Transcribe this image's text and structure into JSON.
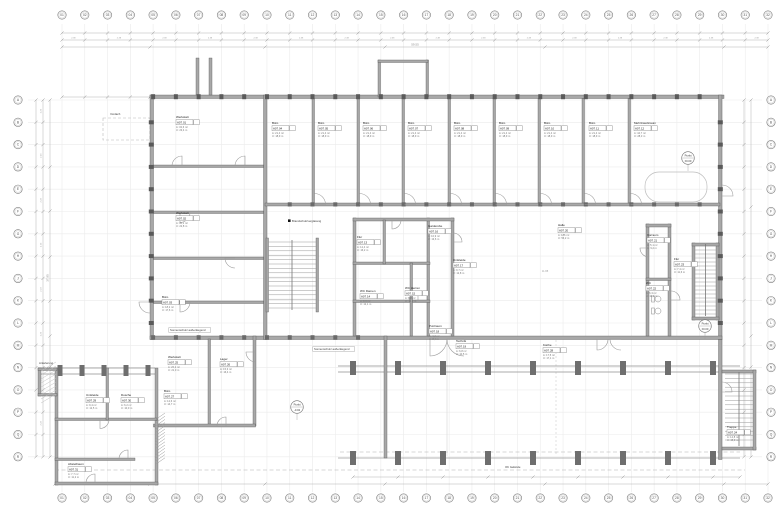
{
  "meta": {
    "drawing_type": "Grundriss / floor plan working drawing"
  },
  "colors": {
    "paper": "#ffffff",
    "wall_fill": "#a8a8a8",
    "wall_edge": "#4f4f4f",
    "pier": "#6e6e6e",
    "door": "#9b9b9b",
    "dim": "#b2b2b2",
    "grid": "#ebebeb",
    "stair": "#9a9a9a",
    "text": "#3c3c3c",
    "muted": "#8a8a8a"
  },
  "grid": {
    "top": [
      "01",
      "02",
      "03",
      "04",
      "05",
      "06",
      "07",
      "08",
      "09",
      "10",
      "11",
      "12",
      "13",
      "14",
      "15",
      "16",
      "17",
      "18",
      "19",
      "20",
      "21",
      "22",
      "23",
      "24",
      "25",
      "26",
      "27",
      "28",
      "29",
      "30",
      "31",
      "32"
    ],
    "bottom": [
      "01",
      "02",
      "03",
      "04",
      "05",
      "06",
      "07",
      "08",
      "09",
      "10",
      "11",
      "12",
      "13",
      "14",
      "15",
      "16",
      "17",
      "18",
      "19",
      "20",
      "21",
      "22",
      "23",
      "24",
      "25",
      "26",
      "27",
      "28",
      "29",
      "30",
      "31",
      "32"
    ],
    "left": [
      "A",
      "B",
      "C",
      "D",
      "E",
      "F",
      "G",
      "H",
      "J",
      "K",
      "L",
      "M",
      "N",
      "O",
      "P",
      "Q",
      "R"
    ],
    "right": [
      "A",
      "B",
      "C",
      "D",
      "E",
      "F",
      "G",
      "H",
      "J",
      "K",
      "L",
      "M",
      "N",
      "O",
      "P",
      "Q",
      "R"
    ]
  },
  "dims": {
    "module": "2.38",
    "module_side": "2.23",
    "total_top": "59.55",
    "total_left": "37.95",
    "hall_width": "11.88"
  },
  "punkt_markers": [
    {
      "label": "Punkt",
      "value": "±0.00",
      "x": 688,
      "y": 158
    },
    {
      "label": "Punkt",
      "value": "-0.02",
      "x": 297,
      "y": 407
    },
    {
      "label": "Punkt",
      "value": "±0.00",
      "x": 705,
      "y": 326
    }
  ],
  "room_tags": [
    {
      "name": "Werkstatt",
      "id": "A07.01",
      "a": "A: 32,6 m²",
      "u": "U: 23,4 m",
      "x": 176,
      "y": 118
    },
    {
      "name": "Werkstatt",
      "id": "A07.02",
      "a": "A: 30,1 m²",
      "u": "U: 22,8 m",
      "x": 176,
      "y": 214
    },
    {
      "name": "Büro",
      "id": "A07.03",
      "a": "A: 18,2 m²",
      "u": "U: 17,6 m",
      "x": 162,
      "y": 298
    },
    {
      "name": "Büro",
      "id": "A07.04",
      "a": "A: 21,4 m²",
      "u": "U: 18,9 m",
      "x": 272,
      "y": 124
    },
    {
      "name": "Büro",
      "id": "A07.05",
      "a": "A: 21,4 m²",
      "u": "U: 18,9 m",
      "x": 318,
      "y": 124
    },
    {
      "name": "Büro",
      "id": "A07.06",
      "a": "A: 21,4 m²",
      "u": "U: 18,9 m",
      "x": 363,
      "y": 124
    },
    {
      "name": "Büro",
      "id": "A07.07",
      "a": "A: 21,4 m²",
      "u": "U: 18,9 m",
      "x": 408,
      "y": 124
    },
    {
      "name": "Büro",
      "id": "A07.08",
      "a": "A: 21,4 m²",
      "u": "U: 18,9 m",
      "x": 454,
      "y": 124
    },
    {
      "name": "Büro",
      "id": "A07.09",
      "a": "A: 21,4 m²",
      "u": "U: 18,9 m",
      "x": 499,
      "y": 124
    },
    {
      "name": "Büro",
      "id": "A07.10",
      "a": "A: 21,4 m²",
      "u": "U: 18,9 m",
      "x": 544,
      "y": 124
    },
    {
      "name": "Büro",
      "id": "A07.11",
      "a": "A: 21,4 m²",
      "u": "U: 18,9 m",
      "x": 589,
      "y": 124
    },
    {
      "name": "Mehrzweckraum",
      "id": "A07.12",
      "a": "A: 44,7 m²",
      "u": "U: 28,3 m",
      "x": 634,
      "y": 124
    },
    {
      "name": "Flur",
      "id": "A07.13",
      "a": "A: 12,4 m²",
      "u": "U: 16,2 m",
      "x": 357,
      "y": 238
    },
    {
      "name": "WC Damen",
      "id": "A07.14",
      "a": "A: 8,6 m²",
      "u": "U: 12,1 m",
      "x": 360,
      "y": 292
    },
    {
      "name": "WC Herren",
      "id": "A07.15",
      "a": "A: 8,8 m²",
      "u": "U: 12,3 m",
      "x": 405,
      "y": 289
    },
    {
      "name": "Garderobe",
      "id": "A07.16",
      "a": "A: 10,9 m²",
      "u": "U: 13,6 m",
      "x": 428,
      "y": 227
    },
    {
      "name": "Umkleide",
      "id": "A07.17",
      "a": "A: 9,7 m²",
      "u": "U: 12,8 m",
      "x": 453,
      "y": 261
    },
    {
      "name": "Putzraum",
      "id": "A07.18",
      "a": "A: 4,2 m²",
      "u": "U: 8,4 m",
      "x": 429,
      "y": 327
    },
    {
      "name": "Technik",
      "id": "A07.19",
      "a": "A: 6,8 m²",
      "u": "U: 10,5 m",
      "x": 456,
      "y": 342
    },
    {
      "name": "Halle",
      "id": "A07.20",
      "a": "A: 186 m²",
      "u": "U: 56,2 m",
      "x": 558,
      "y": 226
    },
    {
      "name": "Vorraum",
      "id": "A07.21",
      "a": "A: 5,1 m²",
      "u": "U: 9,2 m",
      "x": 647,
      "y": 236
    },
    {
      "name": "WC",
      "id": "A07.22",
      "a": "A: 6,3 m²",
      "u": "U: 10,1 m",
      "x": 646,
      "y": 284
    },
    {
      "name": "Flur",
      "id": "A07.23",
      "a": "A: 7,4 m²",
      "u": "U: 11,6 m",
      "x": 674,
      "y": 260
    },
    {
      "name": "Treppe",
      "id": "A07.24",
      "a": "A: 14,8 m²",
      "u": "U: 15,9 m",
      "x": 727,
      "y": 428
    },
    {
      "name": "Werkstatt",
      "id": "A07.25",
      "a": "A: 26,2 m²",
      "u": "U: 21,0 m",
      "x": 168,
      "y": 358
    },
    {
      "name": "Lager",
      "id": "A07.26",
      "a": "A: 15,3 m²",
      "u": "U: 16,4 m",
      "x": 220,
      "y": 360
    },
    {
      "name": "Büro",
      "id": "A07.27",
      "a": "A: 12,6 m²",
      "u": "U: 14,7 m",
      "x": 164,
      "y": 392
    },
    {
      "name": "Küche",
      "id": "A07.28",
      "a": "A: 17,5 m²",
      "u": "U: 17,1 m",
      "x": 543,
      "y": 346
    },
    {
      "name": "Umkleide",
      "id": "A07.29",
      "a": "A: 9,4 m²",
      "u": "U: 12,5 m",
      "x": 86,
      "y": 396
    },
    {
      "name": "Dusche",
      "id": "A07.30",
      "a": "A: 6,2 m²",
      "u": "U: 10,0 m",
      "x": 121,
      "y": 396
    },
    {
      "name": "Abstellraum",
      "id": "A07.31",
      "a": "A: 7,7 m²",
      "u": "U: 11,2 m",
      "x": 68,
      "y": 465
    }
  ],
  "annotations": [
    {
      "text": "Brandschutzverglasung",
      "x": 292,
      "y": 222,
      "marker": 1
    },
    {
      "text": "Sonnenschutz außenliegend",
      "x": 170,
      "y": 331,
      "box": 1
    },
    {
      "text": "Sonnenschutz außenliegend",
      "x": 314,
      "y": 350,
      "box": 1
    },
    {
      "text": "Vordach",
      "x": 110,
      "y": 115
    },
    {
      "text": "Anlieferung",
      "x": 39,
      "y": 364
    },
    {
      "text": "OK Gelände",
      "x": 505,
      "y": 468
    }
  ]
}
